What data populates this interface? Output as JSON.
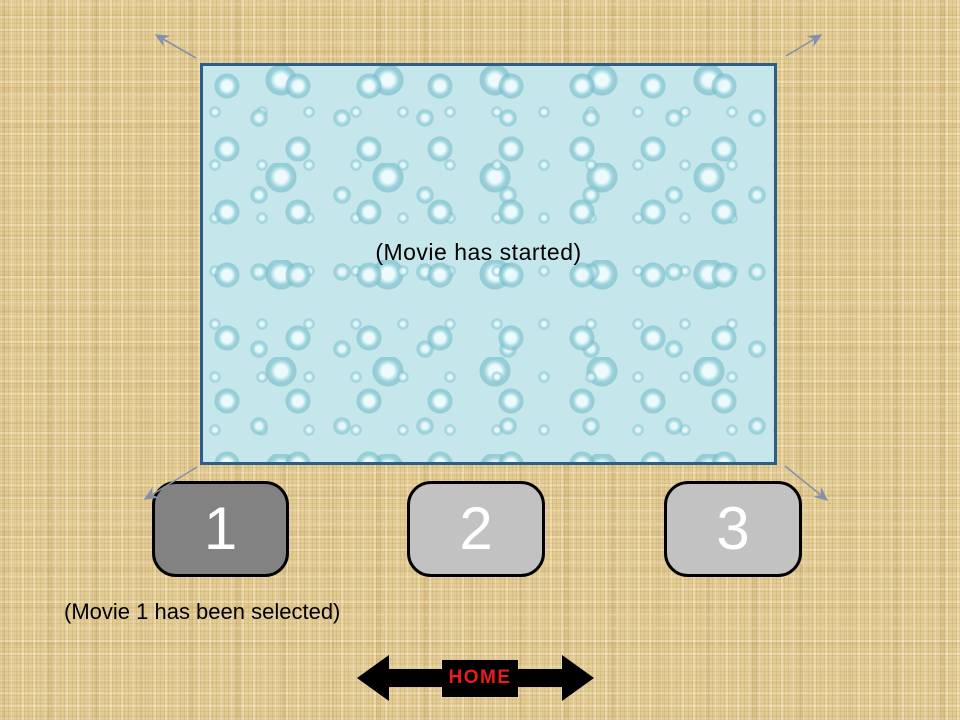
{
  "movie": {
    "status_text": "(Movie has started)"
  },
  "movie_buttons": [
    {
      "label": "1",
      "selected": true
    },
    {
      "label": "2",
      "selected": false
    },
    {
      "label": "3",
      "selected": false
    }
  ],
  "caption": {
    "text": "(Movie 1 has been selected)"
  },
  "nav": {
    "home_label": "HOME",
    "prev_icon": "left-block-arrow",
    "next_icon": "right-block-arrow"
  },
  "decorations": {
    "corner_arrows": [
      "arrow-up-left",
      "arrow-up-right",
      "arrow-down-left",
      "arrow-down-right"
    ]
  },
  "colors": {
    "background_tan": "#e2cb94",
    "movie_fill": "#c5e7eb",
    "movie_border": "#2d5f86",
    "button_selected_fill": "#828282",
    "button_unselected_fill": "#c2c2c2",
    "button_border": "#000000",
    "button_digit": "#ffffff",
    "nav_black": "#000000",
    "home_text_red": "#e81c1c",
    "corner_arrow": "#8591a8"
  }
}
